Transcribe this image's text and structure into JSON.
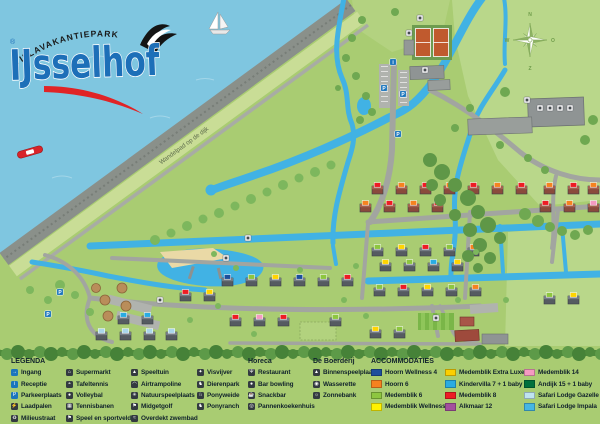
{
  "logo": {
    "park_type": "VILLAVAKANTIEPARK",
    "name": "IJsselhof",
    "registered_mark": "®"
  },
  "map_labels": {
    "dike_path": "Wandelpad op de dijk",
    "compass": {
      "n": "N",
      "e": "O",
      "s": "Z",
      "w": "W"
    }
  },
  "colors": {
    "water": "#7fc6e0",
    "canal": "#41b2e4",
    "grass": "#a9cc72",
    "field_light": "#b9d78a",
    "dike": "#8a908a",
    "road": "#a2a5a0",
    "sand": "#ead9a6",
    "accent_blue_sign": "#1b75bc"
  },
  "legend": {
    "columns": [
      {
        "title": "LEGENDA",
        "items": [
          {
            "icon": "entrance-icon",
            "style": "blue",
            "label": "Ingang"
          },
          {
            "icon": "reception-icon",
            "style": "blue",
            "label": "Receptie"
          },
          {
            "icon": "parking-icon",
            "style": "blue",
            "label": "Parkeerplaats"
          },
          {
            "icon": "charging-station-icon",
            "style": "dark",
            "label": "Laadpalen"
          },
          {
            "icon": "recycling-icon",
            "style": "dark",
            "label": "Milieustraat"
          }
        ]
      },
      {
        "items": [
          {
            "icon": "supermarket-icon",
            "style": "dark",
            "label": "Supermarkt"
          },
          {
            "icon": "table-tennis-icon",
            "style": "dark",
            "label": "Tafeltennis"
          },
          {
            "icon": "volleyball-icon",
            "style": "dark",
            "label": "Volleybal"
          },
          {
            "icon": "tennis-court-icon",
            "style": "dark",
            "label": "Tennisbanen"
          },
          {
            "icon": "sports-field-icon",
            "style": "dark",
            "label": "Speel en sportveld"
          }
        ]
      },
      {
        "items": [
          {
            "icon": "playground-icon",
            "style": "dark",
            "label": "Speeltuin"
          },
          {
            "icon": "air-trampoline-icon",
            "style": "dark",
            "label": "Airtrampoline"
          },
          {
            "icon": "nature-playground-icon",
            "style": "dark",
            "label": "Natuurspeelplaats"
          },
          {
            "icon": "minigolf-icon",
            "style": "dark",
            "label": "Midgetgolf"
          },
          {
            "icon": "indoor-pool-icon",
            "style": "dark",
            "label": "Overdekt zwembad"
          }
        ]
      },
      {
        "items": [
          {
            "icon": "fishing-pond-icon",
            "style": "dark",
            "label": "Visvijver"
          },
          {
            "icon": "animal-park-icon",
            "style": "dark",
            "label": "Dierenpark"
          },
          {
            "icon": "pony-meadow-icon",
            "style": "dark",
            "label": "Ponyweide"
          },
          {
            "icon": "pony-ranch-icon",
            "style": "dark",
            "label": "Ponyranch"
          }
        ]
      },
      {
        "title": "Horeca",
        "items": [
          {
            "icon": "restaurant-icon",
            "style": "dark",
            "label": "Restaurant"
          },
          {
            "icon": "bar-bowling-icon",
            "style": "dark",
            "label": "Bar bowling"
          },
          {
            "icon": "snackbar-icon",
            "style": "dark",
            "label": "Snackbar"
          },
          {
            "icon": "pancake-house-icon",
            "style": "dark",
            "label": "Pannenkoekenhuis"
          }
        ]
      },
      {
        "title": "De Boerderij",
        "items": [
          {
            "icon": "indoor-playground-icon",
            "style": "dark",
            "label": "Binnenspeelplaats"
          },
          {
            "icon": "laundry-icon",
            "style": "dark",
            "label": "Wasserette"
          },
          {
            "icon": "sunbed-icon",
            "style": "dark",
            "label": "Zonnebank"
          }
        ]
      },
      {
        "title": "ACCOMMODATIES",
        "items": [
          {
            "swatch": "#1c4f9c",
            "label": "Hoorn Wellness 4"
          },
          {
            "swatch": "#f58220",
            "label": "Hoorn 6"
          },
          {
            "swatch": "#8dc63f",
            "label": "Medemblik 6"
          },
          {
            "swatch": "#fff200",
            "label": "Medemblik Wellness 6"
          }
        ]
      },
      {
        "items": [
          {
            "swatch": "#fccf00",
            "label": "Medemblik Extra Luxe 4"
          },
          {
            "swatch": "#29abe2",
            "label": "Kindervilla 7 + 1 baby"
          },
          {
            "swatch": "#ed1c24",
            "label": "Medemblik 8"
          },
          {
            "swatch": "#a3509d",
            "label": "Alkmaar 12"
          }
        ]
      },
      {
        "items": [
          {
            "swatch": "#f49ac1",
            "label": "Medemblik 14"
          },
          {
            "swatch": "#00703c",
            "label": "Andijk 15 + 1 baby"
          },
          {
            "swatch": "#bfe3f0",
            "label": "Safari Lodge Gazelle"
          },
          {
            "swatch": "#45b6e3",
            "label": "Safari Lodge Impala"
          }
        ]
      }
    ]
  }
}
